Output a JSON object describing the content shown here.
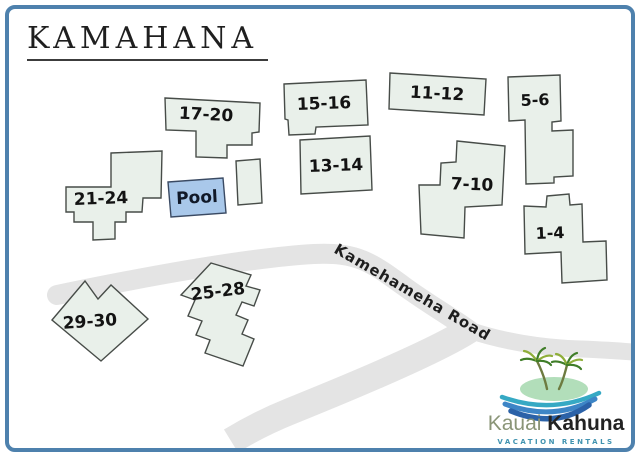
{
  "title": "KAMAHANA",
  "road": {
    "label": "Kamehameha Road"
  },
  "pool": {
    "label": "Pool"
  },
  "buildings": [
    {
      "label": "17-20"
    },
    {
      "label": "15-16"
    },
    {
      "label": "13-14"
    },
    {
      "label": "11-12"
    },
    {
      "label": "5-6"
    },
    {
      "label": "7-10"
    },
    {
      "label": "1-4"
    },
    {
      "label": "21-24"
    },
    {
      "label": "25-28"
    },
    {
      "label": "29-30"
    }
  ],
  "logo": {
    "brand_primary": "Kauai",
    "brand_secondary": "Kahuna",
    "tagline": "Vacation Rentals"
  },
  "colors": {
    "frame_border": "#4e81ad",
    "building_fill": "#e9f0ea",
    "building_stroke": "#474c48",
    "road_fill": "#e4e4e4",
    "pool_fill": "#a9c8ea",
    "pool_stroke": "#3a4a63",
    "label_text": "#131313",
    "title_text": "#1f1f1f",
    "logo_olive": "#8a9577",
    "logo_dark": "#232323",
    "logo_teal": "#4193b0",
    "island_green": "#b2deba",
    "palm_dark": "#3f7d28",
    "palm_light": "#8fae3a",
    "trunk": "#6d7b40",
    "wave_teal": "#36a9c4",
    "wave_mid": "#3d85c6",
    "wave_deep": "#2b62a8"
  }
}
